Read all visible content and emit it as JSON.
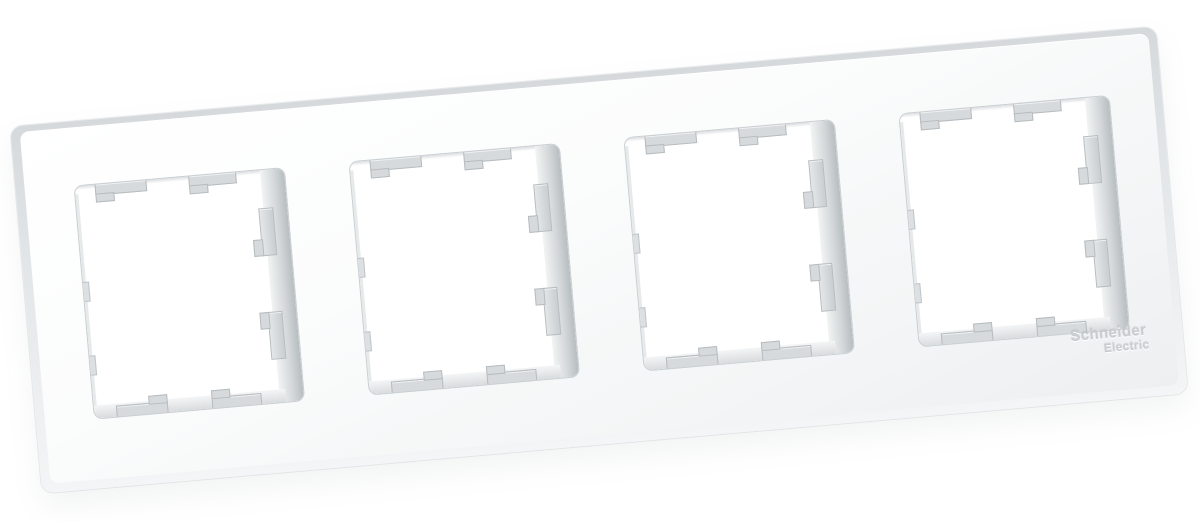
{
  "meta": {
    "description": "Product photo of a white four-gang electrical wall-plate frame on a white background",
    "background_color": "#ffffff"
  },
  "product": {
    "type": "wall-plate-frame",
    "gang_count": 4,
    "frame_color": "#f5f6f7",
    "side_shade_color": "#d5d9db",
    "inner_wall_color": "#b7bdc0",
    "clip_color": "#d7dadc"
  },
  "logo": {
    "line1": "Schneider",
    "line2": "Electric",
    "color": "#c9cdcf"
  },
  "windows": {
    "count": 4,
    "clips_per_window": {
      "top_tabs": 2,
      "bottom_tabs": 2,
      "right_tabs": 2,
      "left_notches": 2
    }
  }
}
